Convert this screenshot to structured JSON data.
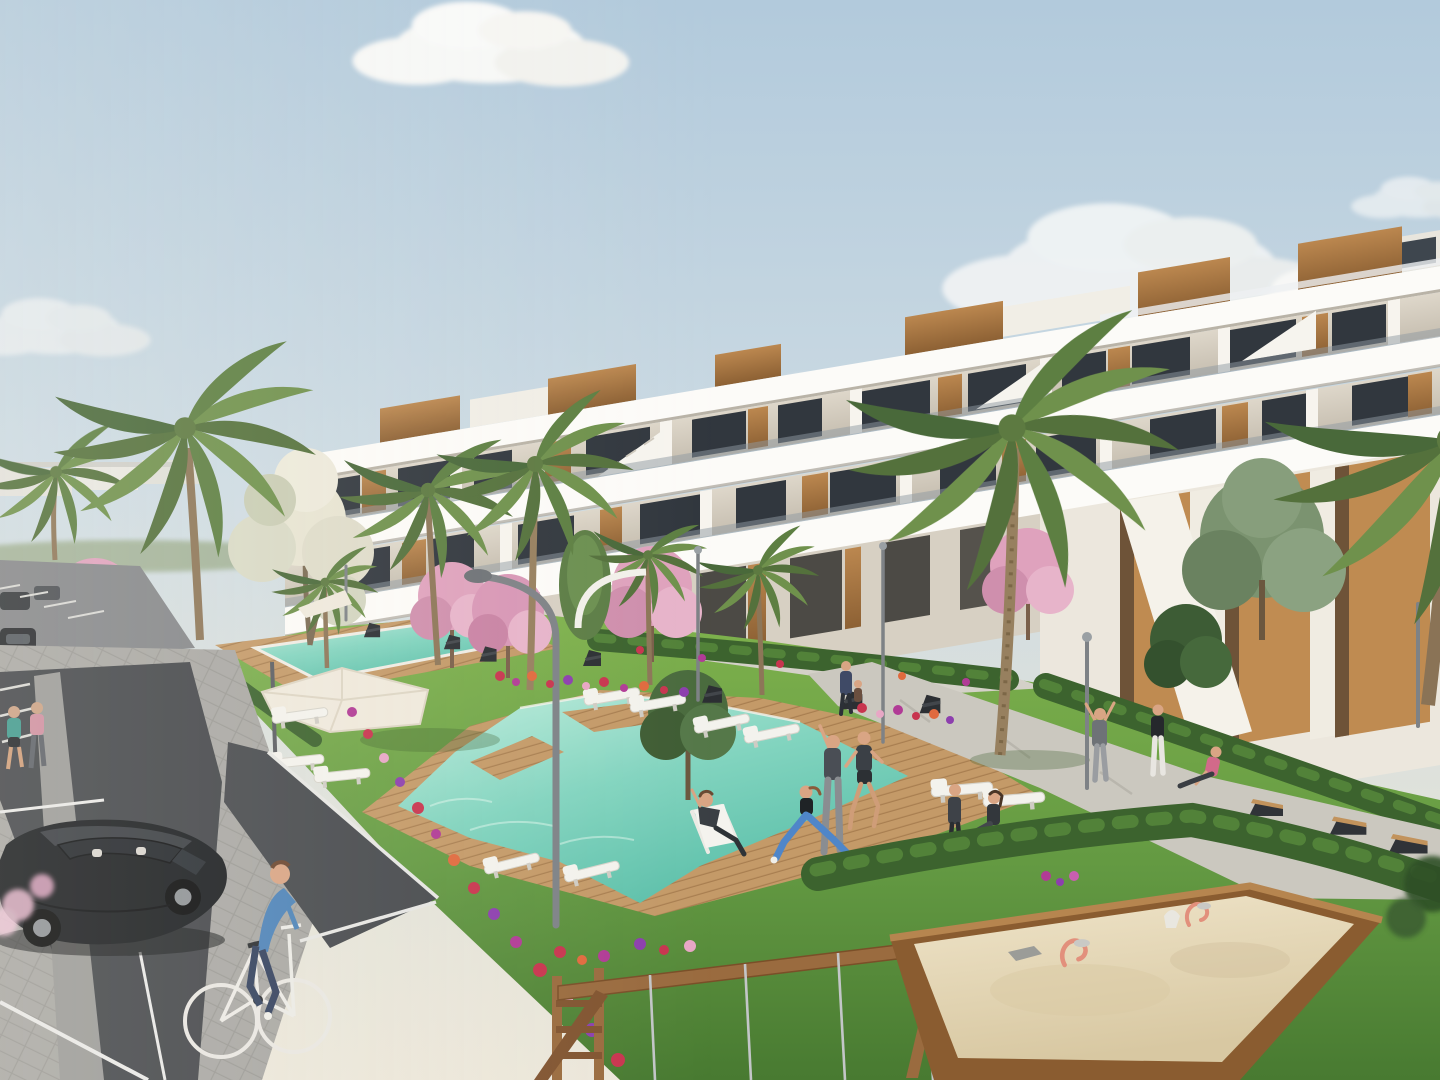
{
  "scene": {
    "type": "3d-architectural-rendering",
    "subject": "Modern white terraced apartment complex with landscaped pool garden, playground and parking",
    "sky": "clear pale blue with scattered soft clouds",
    "lighting": "bright daylight from the left"
  },
  "palette": {
    "sky_top": "#b7cddd",
    "sky_horizon": "#ece7da",
    "cloud": "#fbfaf8",
    "building_white": "#fcfbf8",
    "building_recess": "#d8d1c4",
    "wood_accent": "#ab7c4c",
    "window_glass": "#31373e",
    "glass_rail": "#8f9aa1",
    "pool_shallow": "#bdecdc",
    "pool_deep": "#5bbfa9",
    "deck_wood": "#c49a68",
    "grass": "#6da344",
    "grass_shadow": "#487a31",
    "hedge": "#3c632e",
    "path": "#cbc8bf",
    "asphalt": "#44474b",
    "paver": "#a9a8a4",
    "line_white": "#e9e9e7",
    "sand": "#e7dabc",
    "timber": "#9a6b3f",
    "blossom_pink": "#dfa2bd",
    "blossom_white": "#e7e4d2",
    "flower_red": "#c8354f",
    "flower_magenta": "#b13b96",
    "flower_purple": "#8d3fae",
    "palm_green": "#6f914c",
    "tree_green": "#4a6b3e",
    "car_black": "#1b1e21",
    "cyclist_blue": "#4d83b8",
    "toy_coral": "#e2907c",
    "skin": "#d9a584"
  },
  "objects": {
    "buildings": {
      "style": "terraced white apartments, 3 visible floors",
      "features": [
        "wood-slat rooftop boxes",
        "glass balcony railings",
        "vertical wood wall panels",
        "external staircases",
        "ochre ground-floor niches"
      ]
    },
    "pools": [
      {
        "id": "main-pool",
        "shape": "irregular with wooden deck islands"
      },
      {
        "id": "upper-pool",
        "shape": "long rectangle"
      },
      {
        "id": "edge-pool",
        "shape": "partial at left edge with round spa"
      }
    ],
    "vegetation": [
      "palm trees",
      "pink blossom trees",
      "white blossom tree",
      "olive trees",
      "poplar",
      "hedges",
      "flower beds",
      "lawns"
    ],
    "people": [
      {
        "id": "jogger-1",
        "activity": "jogging on sidewalk",
        "top_color": "#3f9a8e"
      },
      {
        "id": "jogger-2",
        "activity": "jogging on sidewalk",
        "top_color": "#cf8fa0"
      },
      {
        "id": "cyclist",
        "activity": "riding bicycle",
        "top_color": "#4d83b8"
      },
      {
        "id": "man-with-ball",
        "activity": "walking with a ball",
        "top_color": "#75797d"
      },
      {
        "id": "man-red",
        "activity": "reaching into flower bed",
        "top_color": "#c0392b"
      },
      {
        "id": "deckchair-person",
        "activity": "sitting in white deck chair",
        "top_color": "#3a3f44"
      },
      {
        "id": "stretching-man",
        "activity": "stretching with arm raised",
        "top_color": "#4a4e55"
      },
      {
        "id": "lunging-woman",
        "activity": "yoga lunge",
        "leggings_color": "#4f86c9"
      },
      {
        "id": "running-man",
        "activity": "running",
        "top_color": "#3b4046"
      },
      {
        "id": "child",
        "activity": "standing on lawn"
      },
      {
        "id": "sitting-woman",
        "activity": "sitting on lawn"
      },
      {
        "id": "arms-up-man",
        "activity": "stretching both arms up"
      },
      {
        "id": "white-pants-woman",
        "activity": "standing on path"
      },
      {
        "id": "pink-sitting-woman",
        "activity": "floor stretch on path"
      },
      {
        "id": "parent-with-child",
        "activity": "walking on upper path"
      }
    ],
    "vehicles": [
      {
        "id": "black-hatchback",
        "state": "parked in marked bay"
      },
      {
        "id": "distant-parked-cars",
        "count": 3
      }
    ],
    "furniture": {
      "sun_loungers": 11,
      "umbrellas": 2,
      "angular_chairs": 7,
      "path_benches": 3,
      "arc_lamps": 2,
      "pole_lamps": 5
    },
    "playground": {
      "sandbox": 1,
      "spring_toys": 2,
      "swing_frame": 1,
      "sand_toys": 2
    }
  }
}
